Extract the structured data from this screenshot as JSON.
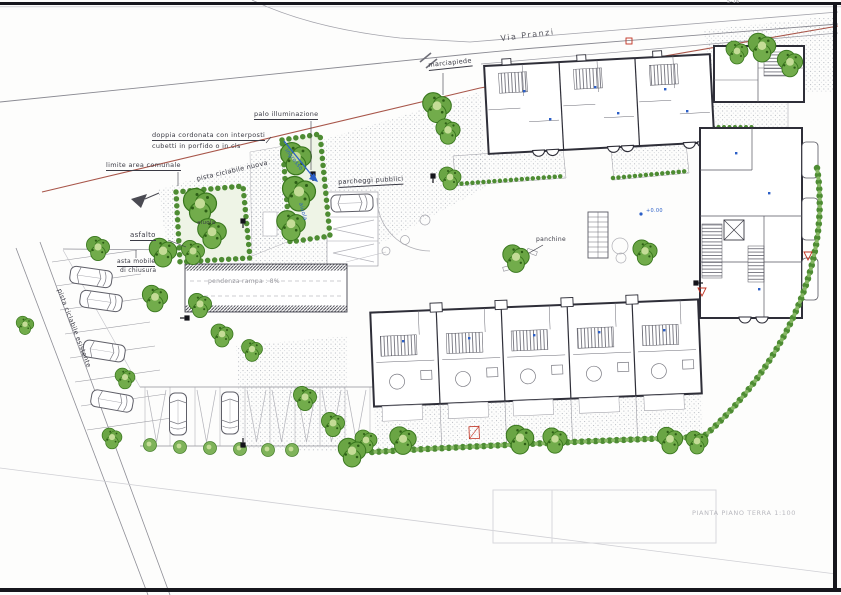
{
  "drawing": {
    "sheet_title": "PIANTA PIANO TERRA 1:100",
    "sheet_ref": "5-16"
  },
  "labels": {
    "street": "Via Pranzi",
    "sidewalk": "marciapiede",
    "lamp_post": "palo illuminazione",
    "curb_note_line1": "doppia cordonata con interposti",
    "curb_note_line2": "cubetti in porfido o in cls",
    "municipal_boundary": "limite area comunale",
    "new_cycle_path": "pista ciclabile nuova",
    "existing_cycle_path": "pista ciclabile esistente",
    "asphalt": "asfalto",
    "barrier_line1": "asta mobile",
    "barrier_line2": "di chiusura",
    "flowerbed_left": "aiuola",
    "flowerbed_right": "aiuola",
    "public_parking": "parcheggi pubblici",
    "benches": "panchine",
    "ramp_slope": "pendenza rampa : 8%",
    "entrance": "ingresso",
    "spot_elevation": "+0.00"
  },
  "colors": {
    "boundary_line": "#a8564a",
    "vegetation": "#4e8c33",
    "annotation_blue": "#2b5fc7",
    "ink": "#2e2e38"
  }
}
